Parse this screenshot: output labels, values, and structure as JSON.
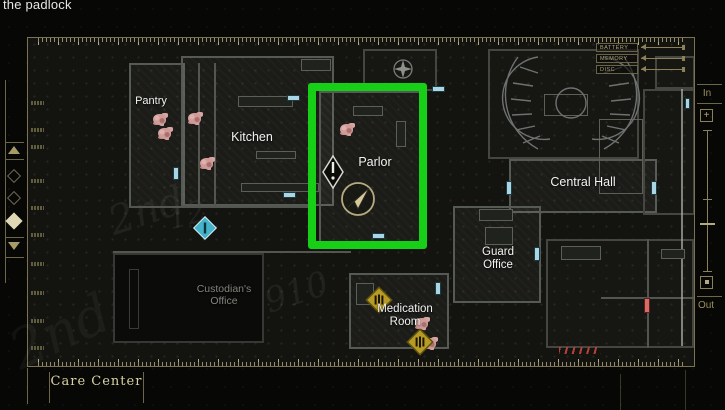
{
  "header": {
    "caption": "the padlock"
  },
  "map": {
    "title": "Care Center",
    "area_map_label": "AREA MAP",
    "legend": [
      {
        "label": "BATTERY"
      },
      {
        "label": "MEMORY"
      },
      {
        "label": "DISC"
      }
    ],
    "zoom_control": {
      "in_label": "In",
      "out_label": "Out",
      "zoom_in": "+",
      "zoom_out": ""
    },
    "rooms": {
      "pantry": "Pantry",
      "kitchen": "Kitchen",
      "parlor": "Parlor",
      "central_hall": "Central Hall",
      "guard_office": "Guard Office",
      "medication_room": "Medication Room",
      "custodians_office": "Custodian's Office"
    },
    "highlight": {
      "room": "Parlor",
      "color": "#17cf17"
    },
    "markers": {
      "player": 1,
      "objective_exclamation": 1,
      "supply_cabinet_diamonds": 2,
      "teal_diamond": 1,
      "herb_pickups": 7,
      "doors_cyan": 10,
      "doors_locked_red": 1,
      "door_color": "#a9d6e4",
      "locked_door_color": "#d96a66",
      "supply_color": "#b89b24",
      "herb_color": "#cf9b98"
    },
    "decor": {
      "script_1": "2nd",
      "script_2": "12",
      "script_3": "O",
      "script_4": "1910"
    }
  }
}
